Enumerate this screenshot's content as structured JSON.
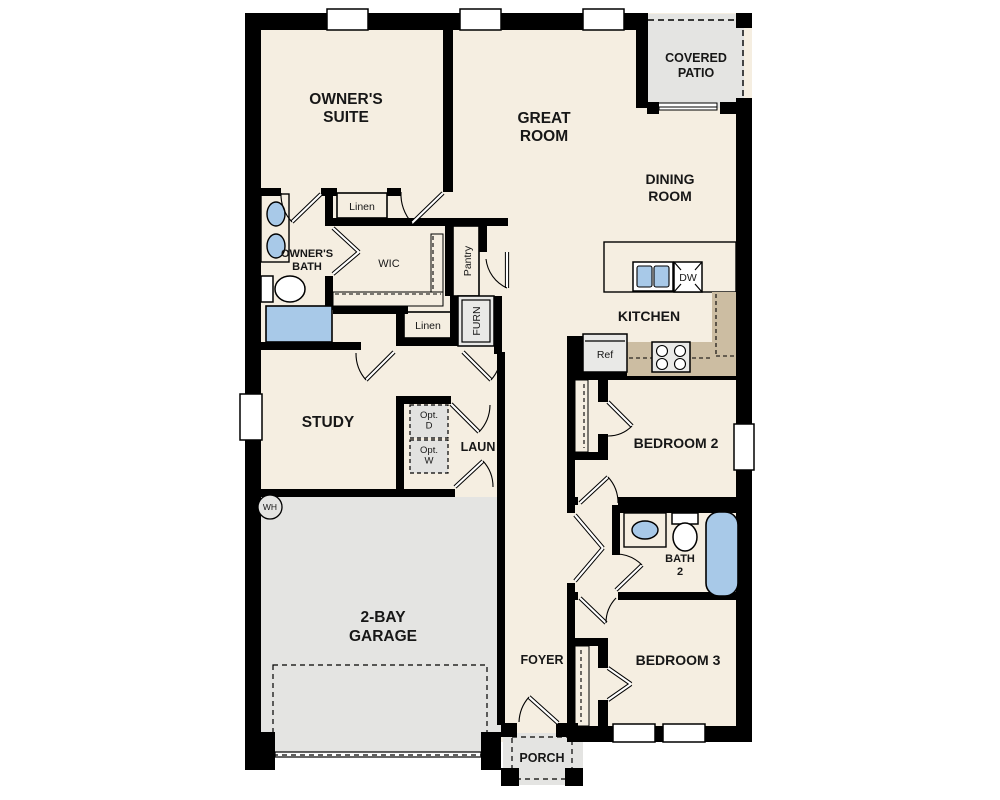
{
  "plan": {
    "type": "single-story-floor-plan",
    "colors": {
      "wall": "#000000",
      "floor": "#f5eee1",
      "garage_patio_porch": "#e4e4e2",
      "casework_tan": "#ccbda2",
      "fixture_blue": "#a8c9e8",
      "appliance_gray": "#e9e9e7",
      "background": "#ffffff"
    },
    "rooms": {
      "owners_suite": "OWNER'S\nSUITE",
      "great_room": "GREAT\nROOM",
      "covered_patio": "COVERED\nPATIO",
      "dining_room": "DINING\nROOM",
      "owners_bath": "OWNER'S\nBATH",
      "wic": "WIC",
      "kitchen": "KITCHEN",
      "study": "STUDY",
      "laundry": "LAUN",
      "garage": "2-BAY\nGARAGE",
      "bedroom2": "BEDROOM 2",
      "bath2": "BATH\n2",
      "bedroom3": "BEDROOM 3",
      "foyer": "FOYER",
      "porch": "PORCH"
    },
    "features": {
      "linen1": "Linen",
      "linen2": "Linen",
      "pantry": "Pantry",
      "furnace": "FURN",
      "dishwasher": "DW",
      "refrigerator": "Ref",
      "water_heater": "WH",
      "opt_dryer": "Opt.\nD",
      "opt_washer": "Opt.\nW"
    }
  }
}
